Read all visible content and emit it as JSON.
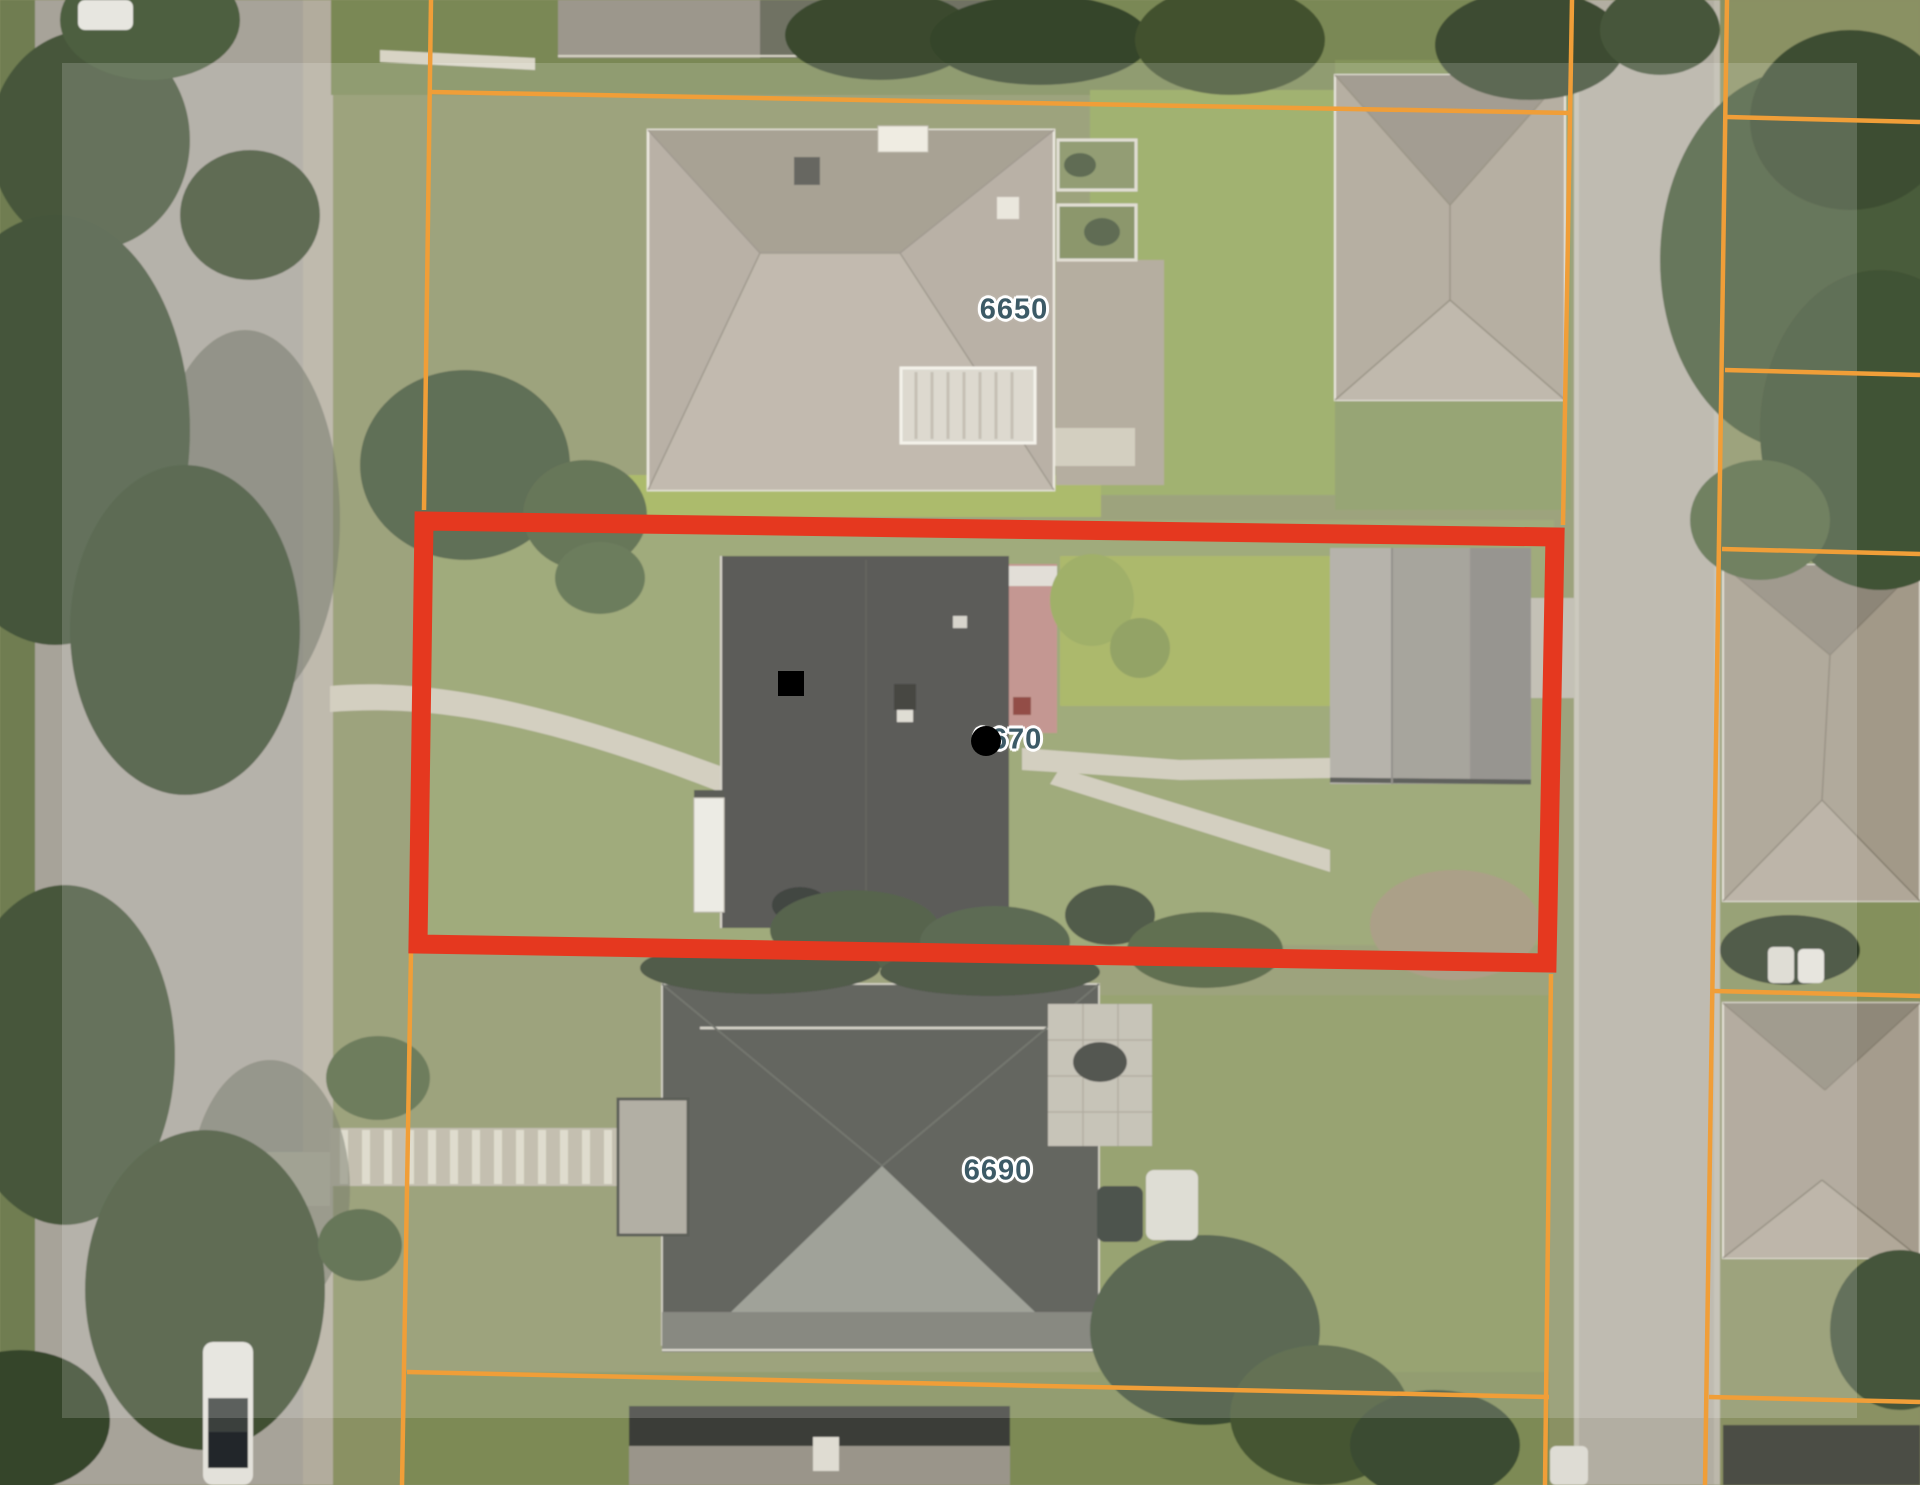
{
  "map": {
    "address_labels": [
      {
        "id": "6650",
        "text": "6650"
      },
      {
        "id": "6670",
        "text": "6670"
      },
      {
        "id": "6690",
        "text": "6690"
      }
    ],
    "colors": {
      "parcel_line": "#F09E38",
      "highlight_outline": "#E5381F",
      "label_text": "#3C5A66",
      "label_halo": "#FFFFFF",
      "marker": "#000000"
    },
    "markers": [
      {
        "name": "marker-square"
      },
      {
        "name": "marker-dot"
      }
    ]
  }
}
